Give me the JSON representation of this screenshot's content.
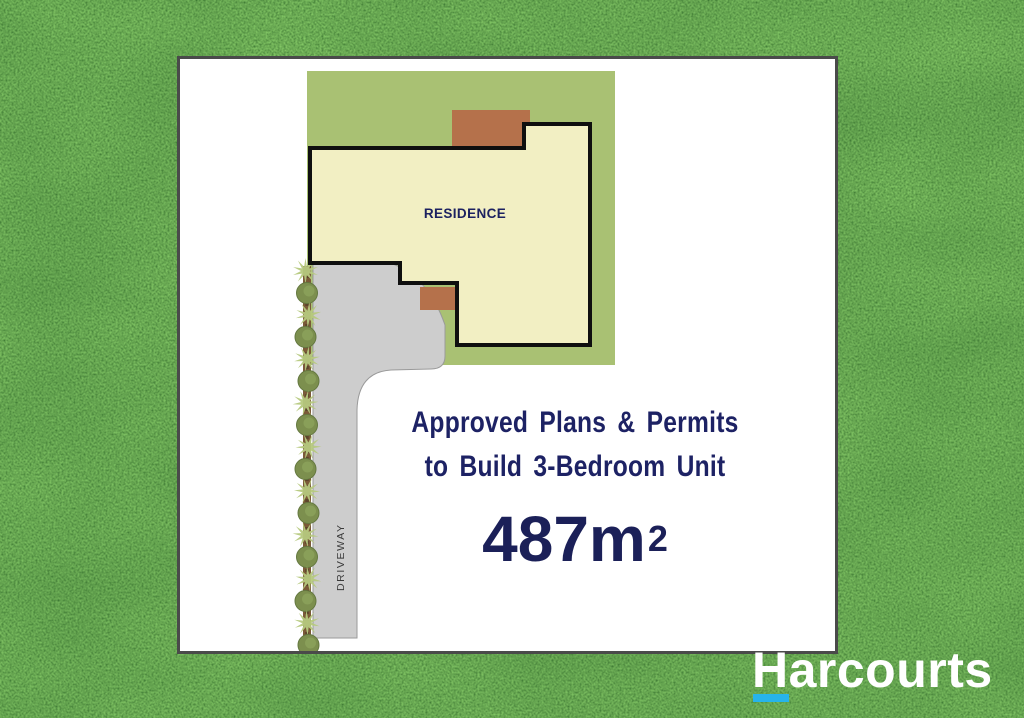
{
  "plan": {
    "residence_label": "RESIDENCE",
    "driveway_label": "DRIVEWAY"
  },
  "headline": {
    "line1": "Approved Plans & Permits",
    "line2": "to Build 3-Bedroom Unit",
    "area_value": "487m",
    "area_exponent": "2",
    "text_color": "#1d2264"
  },
  "brand": {
    "name": "Harcourts",
    "text_color": "#ffffff",
    "accent_color": "#27b4ea"
  },
  "palette": {
    "grass_base": "#2e6e1c",
    "card_border": "#4a4a4a",
    "lot_green": "#a9c173",
    "residence_cream": "#f2efc3",
    "outline_black": "#0f0f0f",
    "structure_brown": "#b5714b",
    "driveway_grey": "#cdcdcd",
    "tree_bush": "#7c8f4e",
    "tree_spike": "#b6c97e",
    "tree_trunk": "#7a5a38"
  }
}
